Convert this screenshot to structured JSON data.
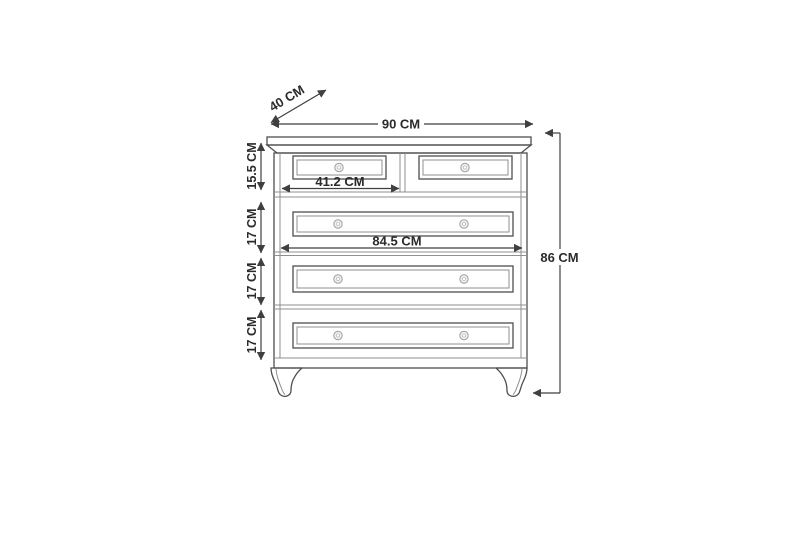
{
  "diagram": {
    "subject": "chest-of-drawers-dimension-drawing",
    "unit": "CM",
    "drawer_count": 5,
    "dimensions": {
      "overall_width": {
        "label": "90 CM",
        "value_cm": 90
      },
      "overall_depth": {
        "label": "40 CM",
        "value_cm": 40
      },
      "overall_height": {
        "label": "86 CM",
        "value_cm": 86
      },
      "top_row_height": {
        "label": "15.5 CM",
        "value_cm": 15.5
      },
      "row2_height": {
        "label": "17 CM",
        "value_cm": 17
      },
      "row3_height": {
        "label": "17 CM",
        "value_cm": 17
      },
      "row4_height": {
        "label": "17 CM",
        "value_cm": 17
      },
      "small_drawer_width": {
        "label": "41.2 CM",
        "value_cm": 41.2
      },
      "wide_drawer_width": {
        "label": "84.5 CM",
        "value_cm": 84.5
      }
    },
    "colors": {
      "background": "#ffffff",
      "furniture_line": "#4f4f4f",
      "dimension_line": "#3f3f3f",
      "text": "#2b2b2b"
    }
  }
}
